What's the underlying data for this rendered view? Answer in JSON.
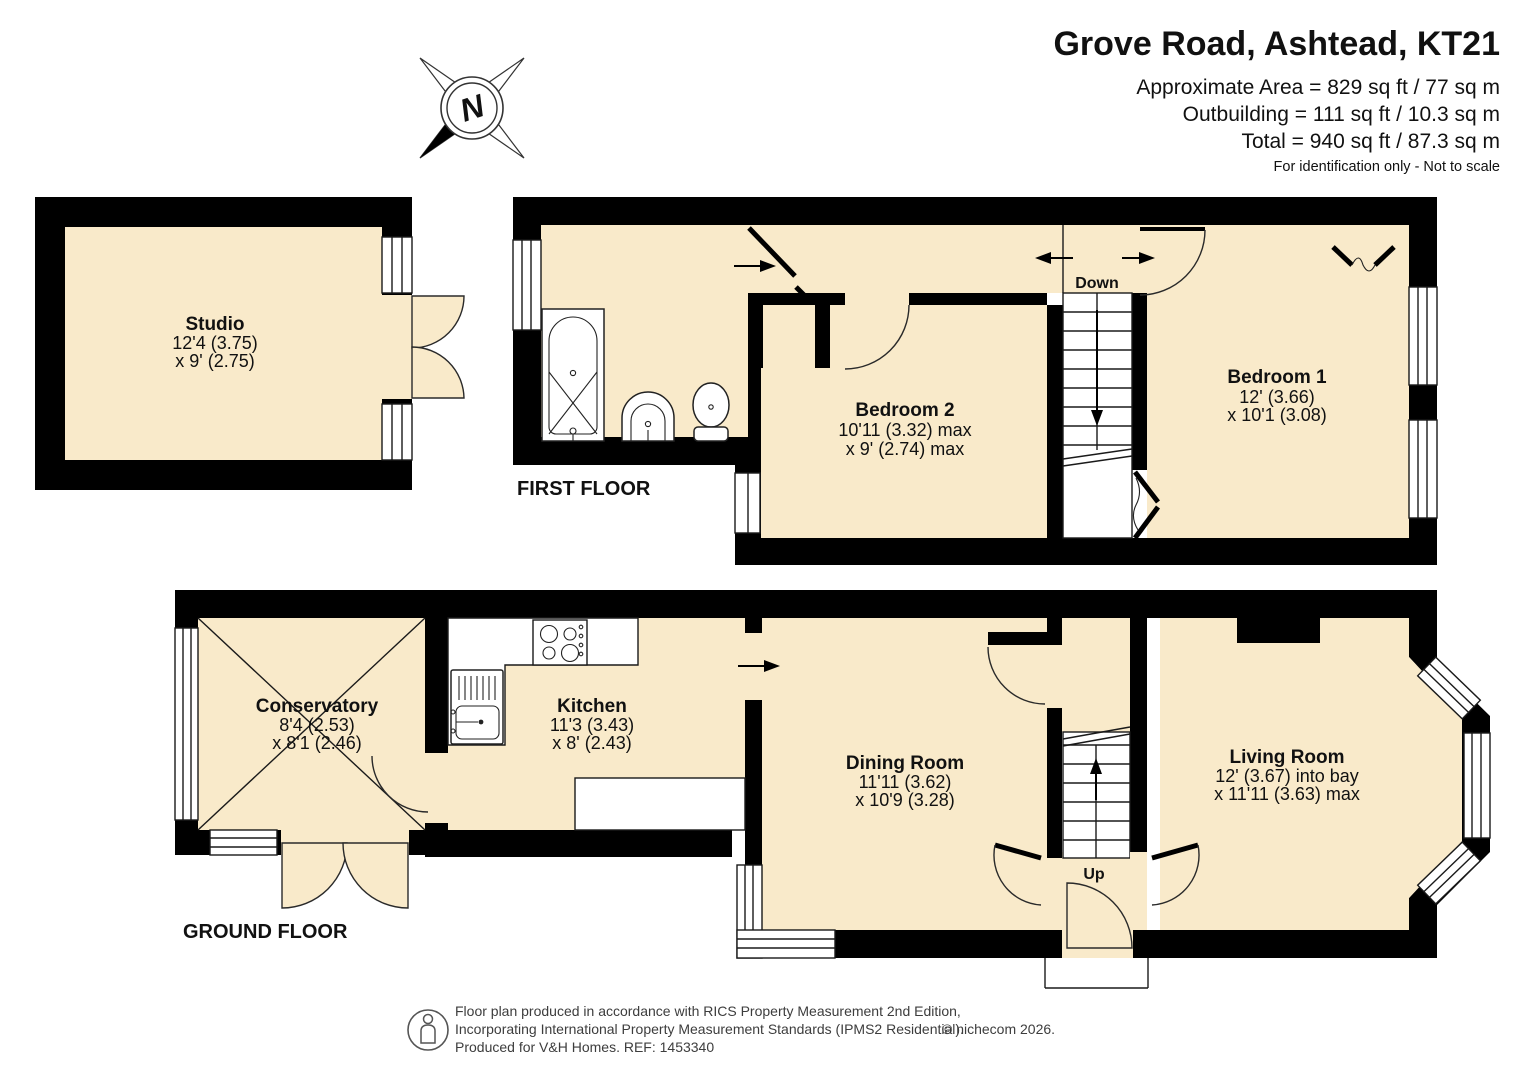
{
  "title": {
    "address": "Grove Road, Ashtead, KT21",
    "area_line1": "Approximate Area = 829 sq ft / 77 sq m",
    "area_line2": "Outbuilding = 111 sq ft / 10.3 sq m",
    "area_line3": "Total = 940 sq ft / 87.3 sq m",
    "disclaimer": "For identification only - Not to scale"
  },
  "floors": {
    "first": "FIRST FLOOR",
    "ground": "GROUND FLOOR"
  },
  "compass": {
    "north": "N"
  },
  "stairs": {
    "down": "Down",
    "up": "Up"
  },
  "rooms": [
    {
      "id": "studio",
      "name": "Studio",
      "dim1": "12'4 (3.75)",
      "dim2": "x 9' (2.75)"
    },
    {
      "id": "bedroom-2",
      "name": "Bedroom 2",
      "dim1": "10'11 (3.32) max",
      "dim2": "x 9' (2.74) max"
    },
    {
      "id": "bedroom-1",
      "name": "Bedroom 1",
      "dim1": "12' (3.66)",
      "dim2": "x 10'1 (3.08)"
    },
    {
      "id": "conservatory",
      "name": "Conservatory",
      "dim1": "8'4 (2.53)",
      "dim2": "x 8'1 (2.46)"
    },
    {
      "id": "kitchen",
      "name": "Kitchen",
      "dim1": "11'3 (3.43)",
      "dim2": "x 8' (2.43)"
    },
    {
      "id": "dining-room",
      "name": "Dining Room",
      "dim1": "11'11 (3.62)",
      "dim2": "x 10'9 (3.28)"
    },
    {
      "id": "living-room",
      "name": "Living Room",
      "dim1": "12' (3.67) into bay",
      "dim2": "x 11'11 (3.63) max"
    }
  ],
  "footer": {
    "line1": "Floor plan produced in accordance with RICS Property Measurement 2nd Edition,",
    "line2": "Incorporating International Property Measurement Standards (IPMS2 Residential).",
    "copyright": "© nichecom 2026.",
    "line3": "Produced for V&H Homes.   REF:  1453340"
  },
  "colors": {
    "room_fill": "#f9eaca",
    "wall": "#000000"
  }
}
